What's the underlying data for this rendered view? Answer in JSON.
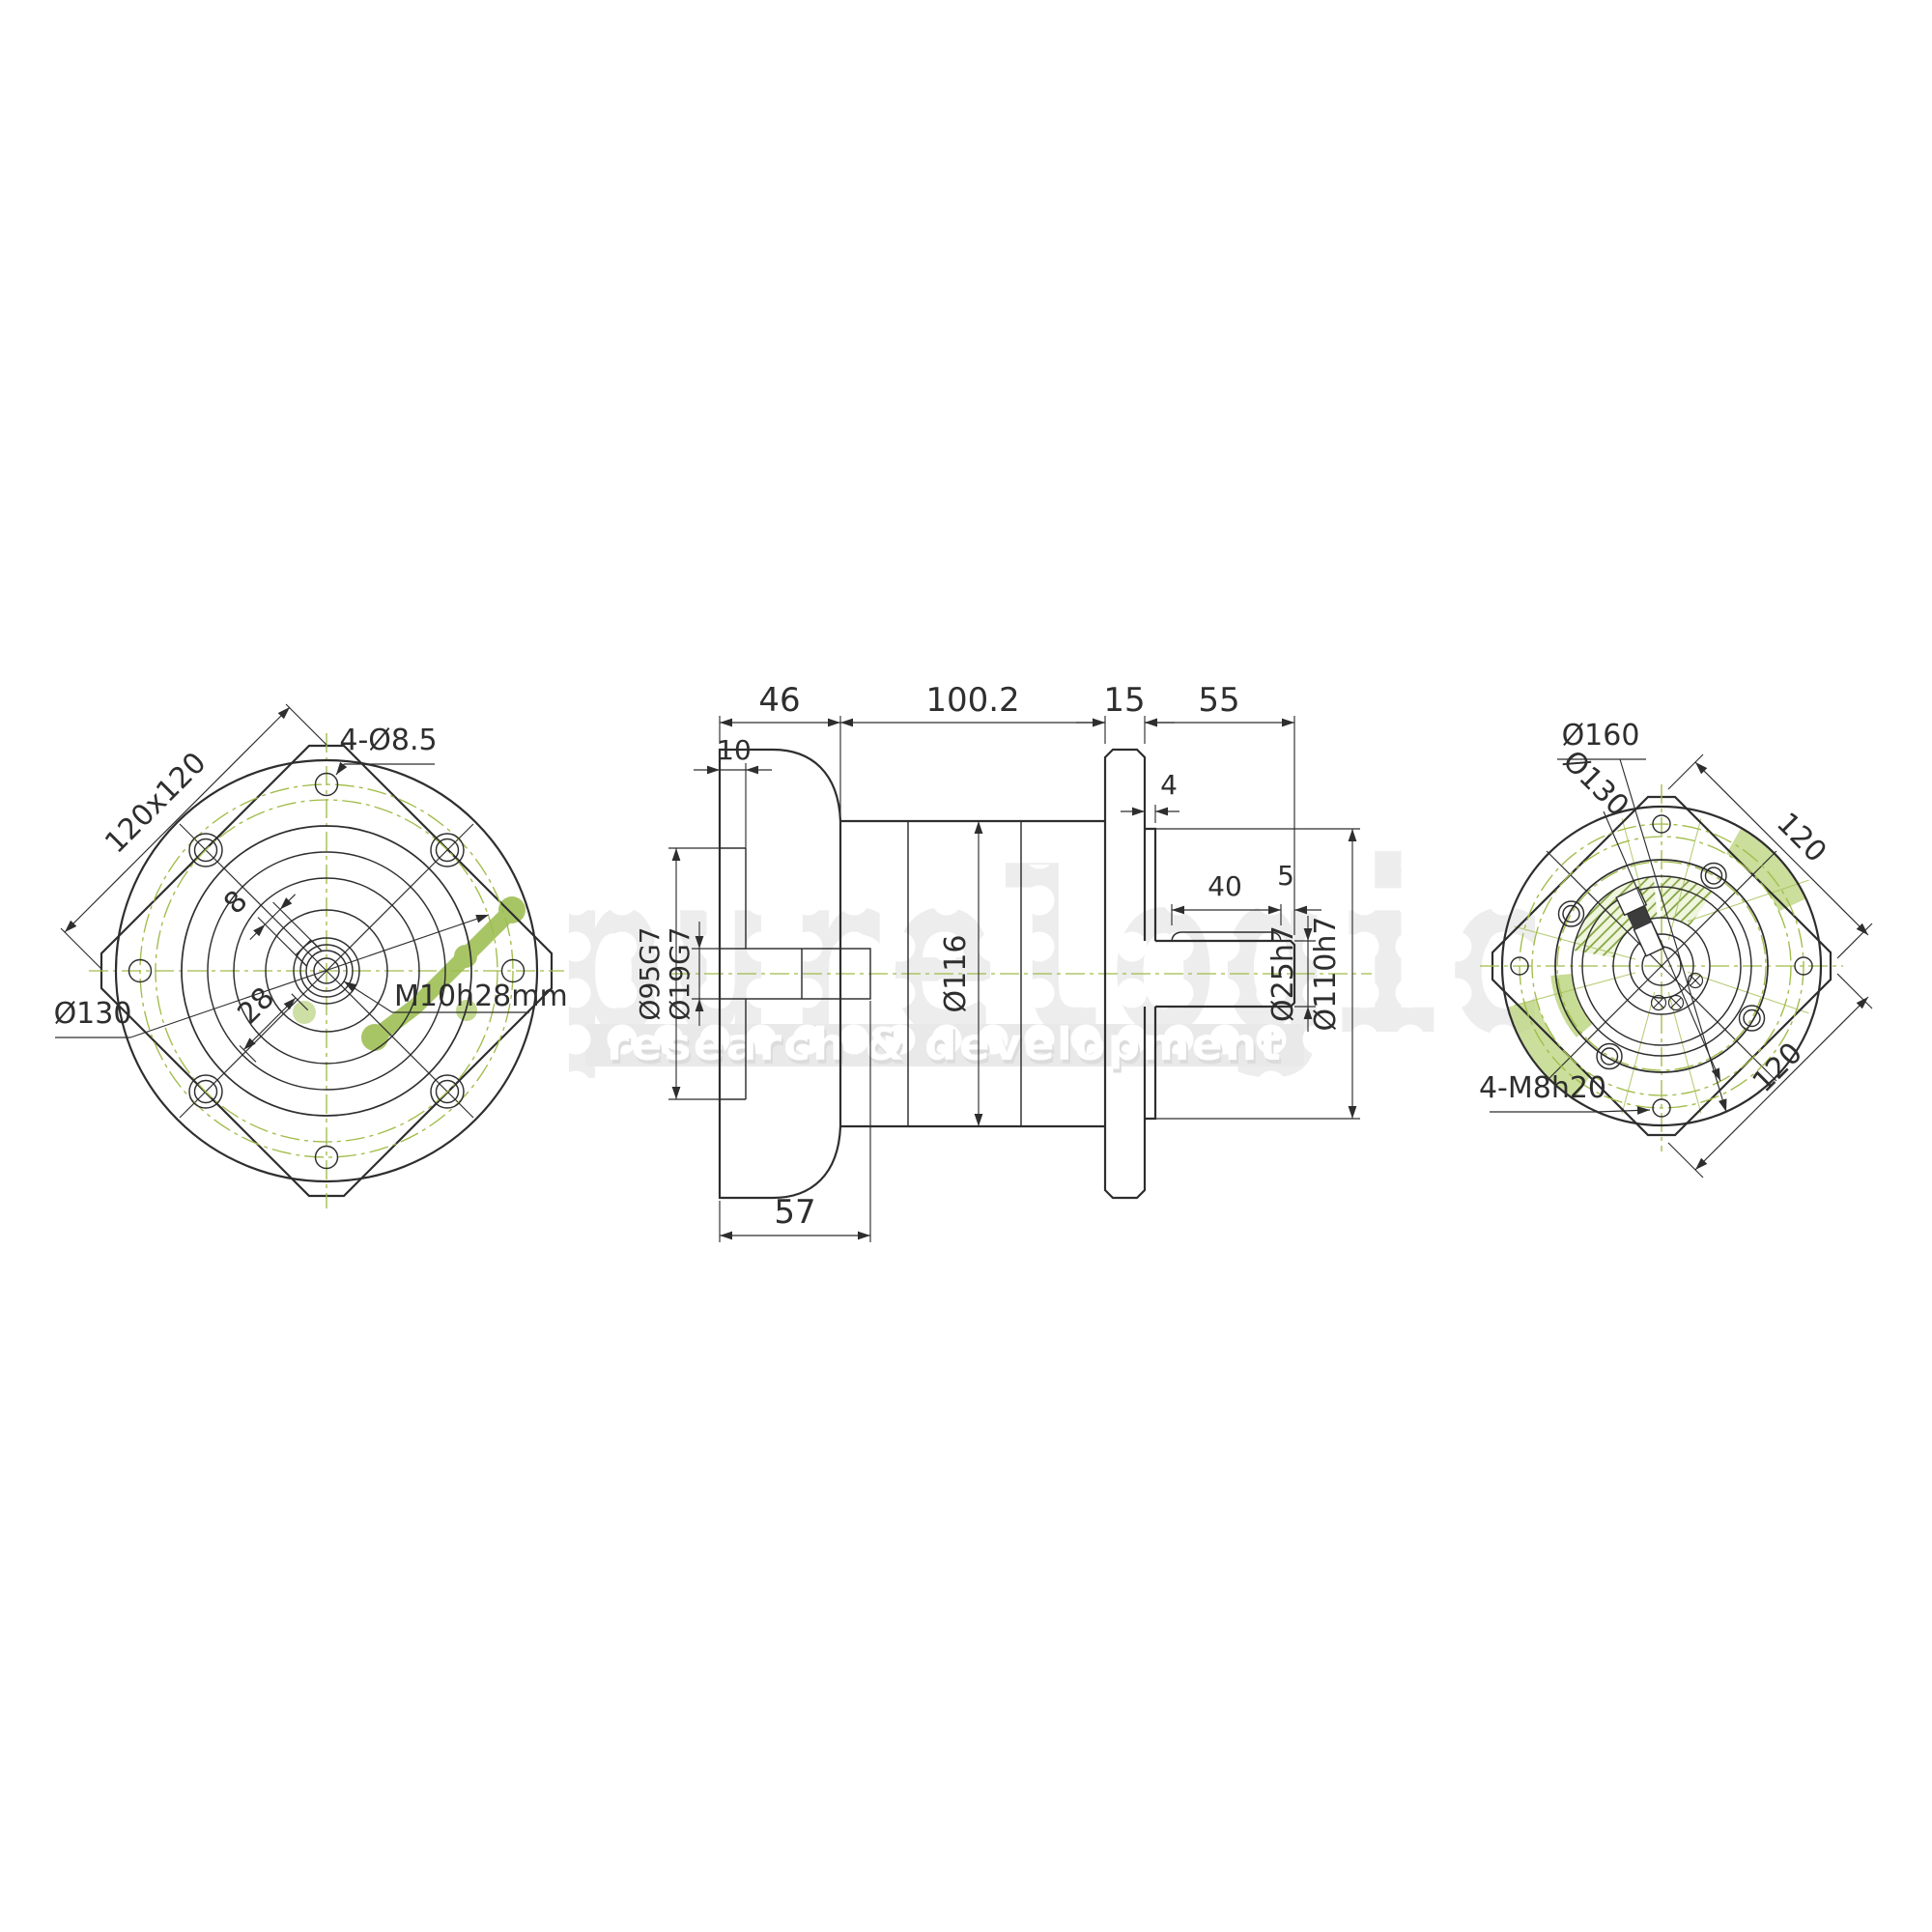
{
  "watermark": {
    "brand": "purelogic",
    "tagline": "research & development",
    "brand_color": "#ededed",
    "accent_green": "#a8c566"
  },
  "front_view": {
    "square_dim": "120x120",
    "corner_holes": "4-Ø8.5",
    "bolt_circle_dia": "Ø130",
    "keyway_width": "8",
    "keyway_span": "28",
    "center_thread": "M10h28mm"
  },
  "side_view": {
    "len_input_flange": "46",
    "len_body": "100.2",
    "len_output_flange": "15",
    "len_shaft": "55",
    "recess_depth": "10",
    "pilot_protrusion": "4",
    "key_length": "40",
    "key_end_offset": "5",
    "body_dia": "Ø116",
    "shaft_dia": "Ø25h7",
    "pilot_dia": "Ø110h7",
    "recess_dia": "Ø95G7",
    "bore_dia": "Ø19G7",
    "flange_total_len": "57"
  },
  "rear_view": {
    "outer_dia": "Ø160",
    "bolt_circle_dia": "Ø130",
    "square_side_top": "120",
    "square_side_bottom": "120",
    "tapped_holes": "4-M8h20"
  }
}
